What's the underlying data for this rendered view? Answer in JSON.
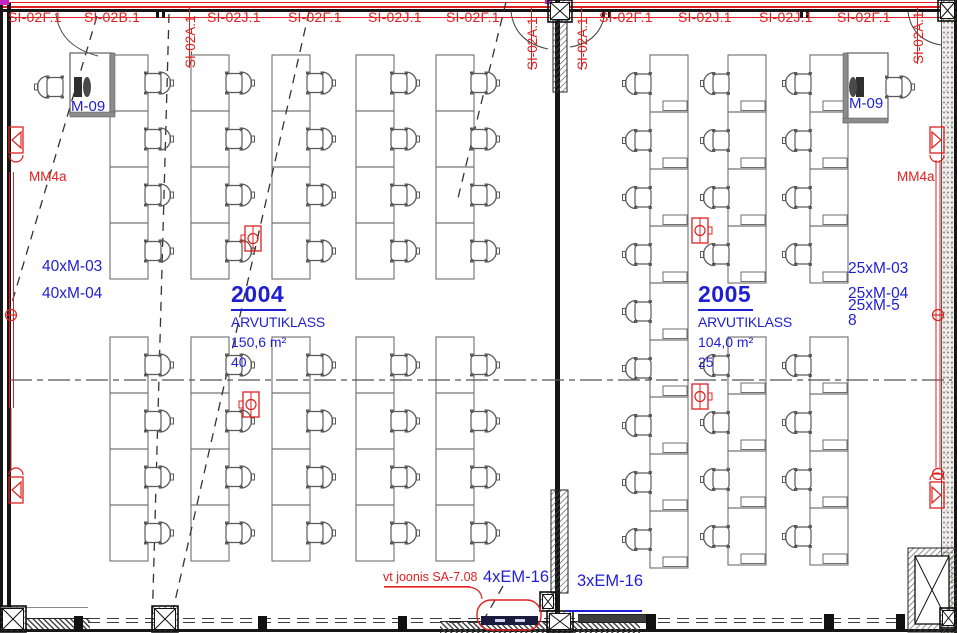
{
  "colors": {
    "red": "#e02020",
    "blue": "#1e1ed2"
  },
  "top_labels": {
    "horizontal": [
      {
        "text": "SI-02F.1",
        "x": 8
      },
      {
        "text": "SI-02B.1",
        "x": 84
      },
      {
        "text": "SI-02J.1",
        "x": 207
      },
      {
        "text": "SI-02F.1",
        "x": 288
      },
      {
        "text": "SI-02J.1",
        "x": 368
      },
      {
        "text": "SI-02F.1",
        "x": 446
      },
      {
        "text": "SI-02F.1",
        "x": 599
      },
      {
        "text": "SI-02J.1",
        "x": 678
      },
      {
        "text": "SI-02J.1",
        "x": 759
      },
      {
        "text": "SI-02F.1",
        "x": 837
      }
    ],
    "vertical": [
      {
        "text": "SI-02A.1",
        "x": 183,
        "y": 68
      },
      {
        "text": "SI-02A.1",
        "x": 525,
        "y": 70
      },
      {
        "text": "SI-02A.1",
        "x": 575,
        "y": 70
      },
      {
        "text": "SI-02A.1",
        "x": 911,
        "y": 64
      }
    ]
  },
  "rooms": [
    {
      "number": "2004",
      "name": "ARVUTIKLASS",
      "area": "150,6 m²",
      "seats": "40"
    },
    {
      "number": "2005",
      "name": "ARVUTIKLASS",
      "area": "104,0 m²",
      "seats": "25"
    }
  ],
  "annotations": {
    "m09_left": "M-09",
    "m09_right": "M-09",
    "mm4a_left": "MM4a",
    "mm4a_right": "MM4a",
    "left_items": [
      {
        "text": "40xM-03",
        "x": 42,
        "y": 258
      },
      {
        "text": "40xM-04",
        "x": 42,
        "y": 285
      }
    ],
    "right_items": [
      {
        "text": "25xM-03",
        "x": 848,
        "y": 260
      },
      {
        "text": "25xM-04",
        "x": 848,
        "y": 285
      },
      {
        "text": "25xM-5",
        "x": 848,
        "y": 297
      },
      {
        "text": "8",
        "x": 848,
        "y": 312
      }
    ],
    "vt_joonis": "vt joonis SA-7.08",
    "em16_4": "4xEM-16",
    "em16_3": "3xEM-16"
  },
  "layout": {
    "room2004": {
      "desk": {
        "w": 38,
        "h": 56
      },
      "columns_x": [
        110,
        191,
        272,
        356,
        436
      ],
      "groups": [
        {
          "y0": 55,
          "rows": 4
        },
        {
          "y0": 337,
          "rows": 4
        }
      ]
    },
    "room2005": {
      "desk": {
        "w": 38,
        "h": 57
      },
      "columns": [
        {
          "x": 650,
          "groups": [
            {
              "y0": 55,
              "rows": 9
            }
          ]
        },
        {
          "x": 728,
          "groups": [
            {
              "y0": 55,
              "rows": 4
            },
            {
              "y0": 337,
              "rows": 4
            }
          ]
        },
        {
          "x": 810,
          "groups": [
            {
              "y0": 55,
              "rows": 4
            },
            {
              "y0": 337,
              "rows": 4
            }
          ]
        }
      ]
    },
    "teachers": [
      {
        "desk": [
          70,
          53,
          42,
          62
        ],
        "strips": [
          [
            110,
            53,
            5,
            62
          ],
          [
            70,
            112,
            45,
            5
          ]
        ],
        "monitor": [
          74,
          77
        ],
        "person": [
          87,
          87
        ],
        "chair": {
          "x": 47,
          "cy": 87,
          "dir": "l"
        }
      },
      {
        "desk": [
          847,
          53,
          41,
          68
        ],
        "strips": [
          [
            843,
            53,
            5,
            70
          ],
          [
            843,
            118,
            45,
            5
          ]
        ],
        "monitor": [
          856,
          77
        ],
        "person": [
          853,
          87
        ],
        "chair": {
          "x": 886,
          "cy": 87,
          "dir": "r"
        }
      }
    ],
    "floor_boxes": [
      {
        "x": 245,
        "y": 226,
        "side": "left"
      },
      {
        "x": 243,
        "y": 392,
        "side": "left"
      },
      {
        "x": 692,
        "y": 218,
        "side": "right"
      },
      {
        "x": 692,
        "y": 384,
        "side": "right"
      }
    ],
    "speakers": [
      {
        "x": 9,
        "y": 127,
        "dir": "r",
        "arc": "below"
      },
      {
        "x": 9,
        "y": 477,
        "dir": "r",
        "arc": "above"
      },
      {
        "x": 930,
        "y": 127,
        "dir": "l",
        "arc": "below"
      },
      {
        "x": 930,
        "y": 482,
        "dir": "l",
        "arc": "above"
      }
    ],
    "circles": [
      [
        11,
        315
      ],
      [
        938,
        315
      ],
      [
        938,
        474
      ]
    ],
    "conduits": [
      [
        9.5,
        172,
        9.5,
        408
      ],
      [
        13.5,
        172,
        13.5,
        408
      ],
      [
        11,
        408,
        11,
        470
      ],
      [
        936,
        160,
        936,
        468
      ],
      [
        940,
        160,
        940,
        468
      ]
    ],
    "dashed_lines": [
      [
        97,
        16,
        8,
        316
      ],
      [
        169,
        14,
        152,
        630
      ],
      [
        309,
        12,
        168,
        632
      ],
      [
        506,
        2,
        458,
        198
      ],
      [
        503,
        586,
        478,
        630
      ]
    ],
    "centerline": [
      10,
      380,
      952,
      380
    ],
    "door_arcs": [
      "M56,14 Q60,46 98,56",
      "M511,12 Q515,42 548,49",
      "M605,12 Q601,42 570,47",
      "M908,12 Q912,40 941,45"
    ],
    "hatch_rects": [
      [
        553,
        20,
        14,
        72
      ],
      [
        551,
        490,
        17,
        103
      ],
      [
        908,
        548,
        49,
        84
      ]
    ],
    "shaft_inner": [
      915,
      556,
      34,
      68
    ],
    "x_boxes": [
      [
        548,
        0,
        24,
        22
      ],
      [
        938,
        0,
        19,
        21
      ],
      [
        0,
        606,
        26,
        26
      ],
      [
        152,
        606,
        26,
        26
      ],
      [
        540,
        592,
        16,
        19
      ],
      [
        547,
        611,
        26,
        21
      ],
      [
        940,
        608,
        17,
        20
      ]
    ],
    "bubble": {
      "rect": [
        477,
        600,
        64,
        30
      ],
      "leader": "M384,587 H468 Q481,588 482,599",
      "tray": [
        481,
        616,
        57,
        9
      ]
    }
  }
}
